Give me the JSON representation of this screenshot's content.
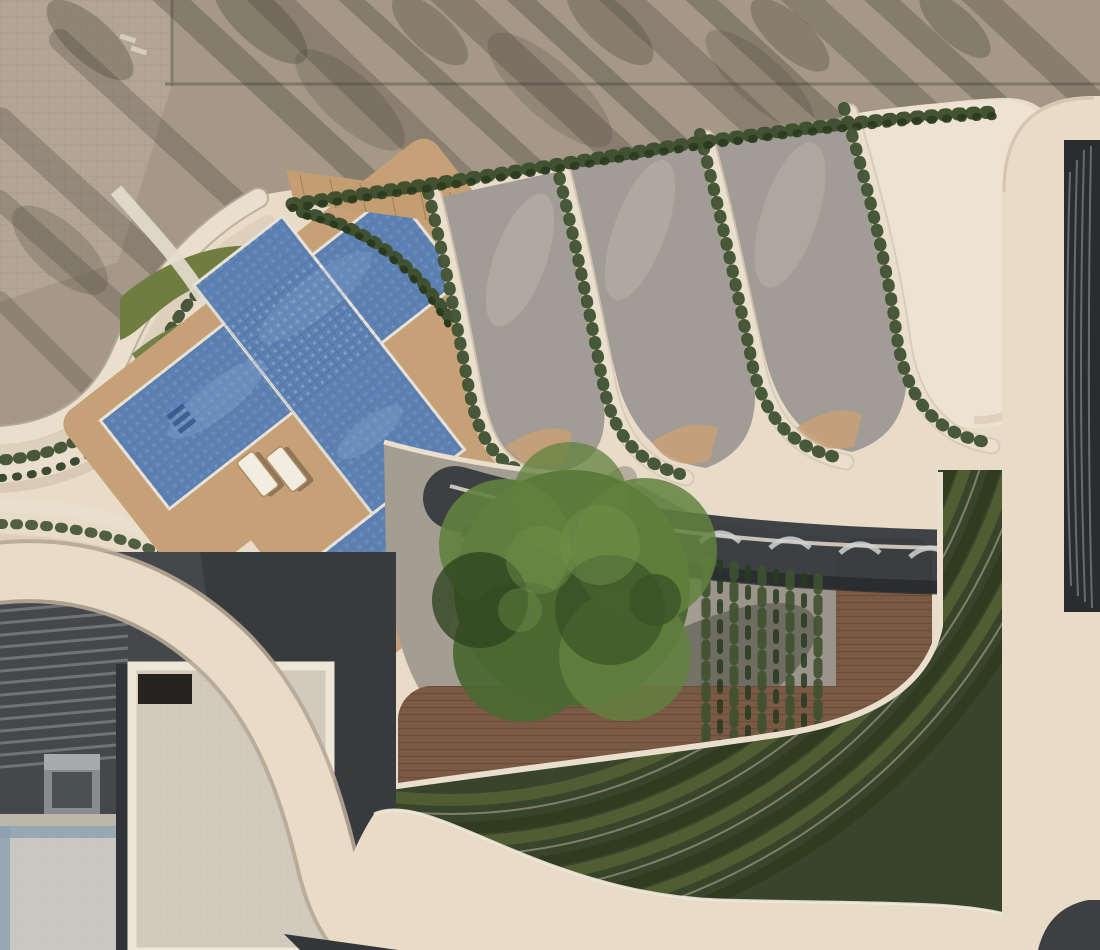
{
  "meta": {
    "description": "Aerial architectural rendering of a residential podium amenity deck: tiled swimming pool with AZIZI tile logo, wooden sun decks, four curved landscaped lounge terraces with hedges, large central tree plaza, outdoor gym deck, terraced green amphitheater, lower courtyard building and surrounding street with parked cars, long tree shadows and pedestrians."
  },
  "branding": {
    "pool_logo_text": "AZIZI"
  },
  "palette": {
    "pavement": "#a59886",
    "pavement_light": "#b3a593",
    "shadow": "#3f3a33",
    "cream": "#e8dbc8",
    "cream_bright": "#eee2d0",
    "cream_dark": "#cbbba6",
    "terrace_gray": "#a19c95",
    "terrace_light": "#bcb5ab",
    "pool_blue": "#5d81b2",
    "pool_dark": "#3b5c90",
    "pool_text": "#2d4f86",
    "deck_tan": "#c6a177",
    "wood": "#7a5a44",
    "lawn": "#6f7d40",
    "hedge": "#3f5130",
    "hedge_dark": "#293a1e",
    "tree": "#4c6833",
    "tree_light": "#61823e",
    "tree_dark": "#2f451f",
    "concrete": "#a49d92",
    "canopy": "#383c3f",
    "lower_roof": "#45484b",
    "patio": "#d2cabc",
    "floor_pale": "#c9c7c2",
    "channel": "#8ba0af",
    "steps_base": "#39452a",
    "steps_light": "#4f5d33",
    "steps_line": "#8e8f75",
    "facade": "#2a2d2f",
    "white_line": "#ece4d6"
  },
  "scene": {
    "cars": [
      {
        "name": "suv-street-top",
        "x": 688,
        "y": 96,
        "w": 96,
        "h": 46,
        "r": 2,
        "body": "#4b5140",
        "glass": "#23261f"
      },
      {
        "name": "car-street-top",
        "x": 437,
        "y": 140,
        "w": 64,
        "h": 32,
        "r": 4,
        "body": "#53565a",
        "glass": "#2c2e31"
      },
      {
        "name": "car-street-left",
        "x": 24,
        "y": 312,
        "w": 52,
        "h": 88,
        "r": 5,
        "body": "#5a5e62",
        "glass": "#33363a"
      }
    ],
    "people": [
      {
        "x": 152,
        "y": 218,
        "c": "#3a3a3a"
      },
      {
        "x": 237,
        "y": 204,
        "c": "#8c2f2f"
      },
      {
        "x": 245,
        "y": 208,
        "c": "#3a3f45"
      },
      {
        "x": 106,
        "y": 296,
        "c": "#2e3338"
      },
      {
        "x": 95,
        "y": 303,
        "c": "#4a3f36"
      },
      {
        "x": 231,
        "y": 370,
        "c": "#b03a2e"
      },
      {
        "x": 217,
        "y": 381,
        "c": "#d4683a"
      },
      {
        "x": 309,
        "y": 431,
        "c": "#d9772f"
      },
      {
        "x": 341,
        "y": 472,
        "c": "#31405a"
      },
      {
        "x": 367,
        "y": 497,
        "c": "#a93226"
      },
      {
        "x": 427,
        "y": 412,
        "c": "#6e6259"
      },
      {
        "x": 454,
        "y": 457,
        "c": "#2f3b4c"
      },
      {
        "x": 521,
        "y": 299,
        "c": "#33415c"
      },
      {
        "x": 627,
        "y": 246,
        "c": "#b03a2e"
      },
      {
        "x": 698,
        "y": 251,
        "c": "#d4683a"
      },
      {
        "x": 794,
        "y": 224,
        "c": "#394556"
      },
      {
        "x": 866,
        "y": 349,
        "c": "#b03a2e"
      },
      {
        "x": 884,
        "y": 394,
        "c": "#d9772f"
      },
      {
        "x": 713,
        "y": 371,
        "c": "#b03a2e"
      },
      {
        "x": 736,
        "y": 391,
        "c": "#2f3b4c"
      },
      {
        "x": 658,
        "y": 545,
        "c": "#2f3b4c"
      },
      {
        "x": 838,
        "y": 443,
        "c": "#7d5a44"
      },
      {
        "x": 560,
        "y": 769,
        "c": "#22272e"
      },
      {
        "x": 679,
        "y": 827,
        "c": "#a93226"
      },
      {
        "x": 851,
        "y": 700,
        "c": "#5f4632"
      },
      {
        "x": 906,
        "y": 744,
        "c": "#2f3b4c"
      },
      {
        "x": 546,
        "y": 768,
        "c": "#22272e"
      },
      {
        "x": 466,
        "y": 743,
        "c": "#33302c"
      },
      {
        "x": 692,
        "y": 764,
        "c": "#55402f"
      },
      {
        "x": 931,
        "y": 737,
        "c": "#7d5a44"
      },
      {
        "x": 806,
        "y": 545,
        "c": "#b03a2e"
      },
      {
        "x": 786,
        "y": 611,
        "c": "#d4683a"
      },
      {
        "x": 797,
        "y": 729,
        "c": "#d9772f"
      }
    ],
    "furniture": [
      {
        "x": 470,
        "y": 250,
        "w": 26,
        "h": 58,
        "r": -32,
        "t": "sofa"
      },
      {
        "x": 500,
        "y": 224,
        "w": 56,
        "h": 24,
        "r": -32,
        "t": "sofa"
      },
      {
        "x": 536,
        "y": 296,
        "w": 20,
        "h": 20,
        "r": -32,
        "t": "table"
      },
      {
        "x": 516,
        "y": 320,
        "w": 18,
        "h": 40,
        "r": -32,
        "t": "lounger"
      },
      {
        "x": 612,
        "y": 232,
        "w": 46,
        "h": 28,
        "r": -28,
        "t": "sofa"
      },
      {
        "x": 646,
        "y": 262,
        "w": 44,
        "h": 30,
        "r": -28,
        "t": "sofa"
      },
      {
        "x": 700,
        "y": 370,
        "w": 18,
        "h": 44,
        "r": -30,
        "t": "lounger"
      },
      {
        "x": 724,
        "y": 392,
        "w": 18,
        "h": 44,
        "r": -30,
        "t": "lounger"
      },
      {
        "x": 764,
        "y": 220,
        "w": 50,
        "h": 30,
        "r": -26,
        "t": "sofa"
      },
      {
        "x": 800,
        "y": 250,
        "w": 40,
        "h": 26,
        "r": -26,
        "t": "sofa"
      },
      {
        "x": 848,
        "y": 350,
        "w": 20,
        "h": 46,
        "r": -30,
        "t": "lounger"
      },
      {
        "x": 874,
        "y": 376,
        "w": 20,
        "h": 46,
        "r": -30,
        "t": "lounger"
      },
      {
        "x": 876,
        "y": 556,
        "w": 22,
        "h": 18,
        "r": 0,
        "t": "cushion"
      },
      {
        "x": 876,
        "y": 590,
        "w": 22,
        "h": 18,
        "r": 0,
        "t": "cushion"
      },
      {
        "x": 872,
        "y": 618,
        "w": 24,
        "h": 20,
        "r": 0,
        "t": "dark"
      },
      {
        "x": 882,
        "y": 700,
        "w": 22,
        "h": 18,
        "r": 0,
        "t": "cushion"
      },
      {
        "x": 884,
        "y": 728,
        "w": 22,
        "h": 18,
        "r": 0,
        "t": "cushion"
      },
      {
        "x": 886,
        "y": 757,
        "w": 22,
        "h": 18,
        "r": 0,
        "t": "cushion"
      },
      {
        "x": 779,
        "y": 712,
        "w": 20,
        "h": 50,
        "r": -8,
        "t": "lounger"
      },
      {
        "x": 808,
        "y": 742,
        "w": 20,
        "h": 50,
        "r": -12,
        "t": "lounger"
      }
    ],
    "gym_equipment": [
      {
        "x": 483,
        "y": 732,
        "w": 15,
        "h": 44,
        "t": "machine"
      },
      {
        "x": 511,
        "y": 732,
        "w": 15,
        "h": 44,
        "t": "machine"
      },
      {
        "x": 539,
        "y": 732,
        "w": 15,
        "h": 44,
        "t": "machine"
      },
      {
        "x": 590,
        "y": 732,
        "w": 16,
        "h": 46,
        "t": "dark"
      },
      {
        "x": 624,
        "y": 732,
        "w": 16,
        "h": 46,
        "t": "dark"
      },
      {
        "x": 446,
        "y": 734,
        "w": 30,
        "h": 12,
        "t": "dark"
      },
      {
        "x": 683,
        "y": 750,
        "w": 14,
        "h": 36,
        "t": "dark"
      }
    ]
  }
}
